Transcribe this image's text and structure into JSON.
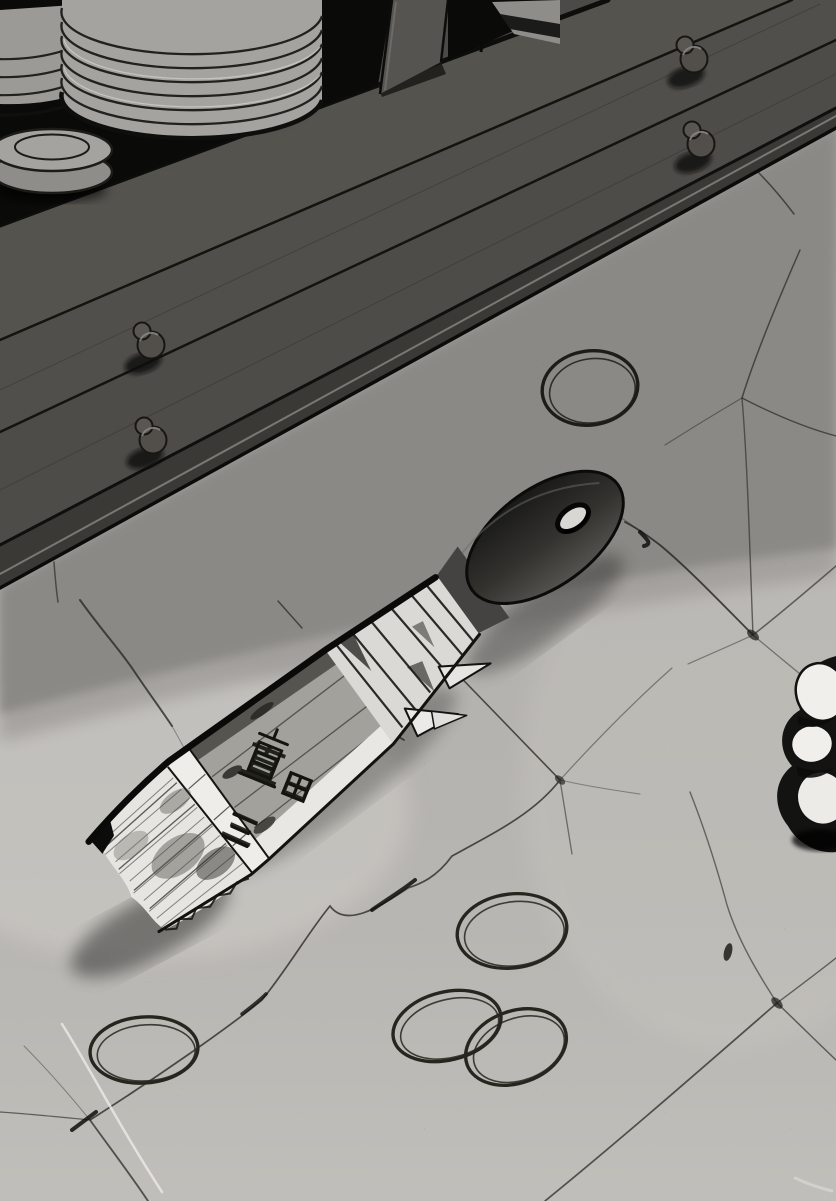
{
  "panel": {
    "kind": "manga floor scene",
    "objects": {
      "cabinet": "dark wooden tansu cabinet with shelf and drawers",
      "plate_stack_count": 3,
      "drawer_knob_count": 4,
      "paintbrush": "flat hake brush lying on stone floor",
      "rubber_band_count": 5,
      "cloth_object": "white crumpled object at right edge"
    }
  },
  "brush_label": {
    "char1": "直",
    "char2": "田",
    "char3": "三",
    "full": "直田三"
  },
  "palette": {
    "ink": "#141411",
    "cabinet": "#4c4a46",
    "floor_shadow": "#8b8985",
    "floor_light": "#b4b2ae",
    "paper_white": "#f0eeea"
  }
}
